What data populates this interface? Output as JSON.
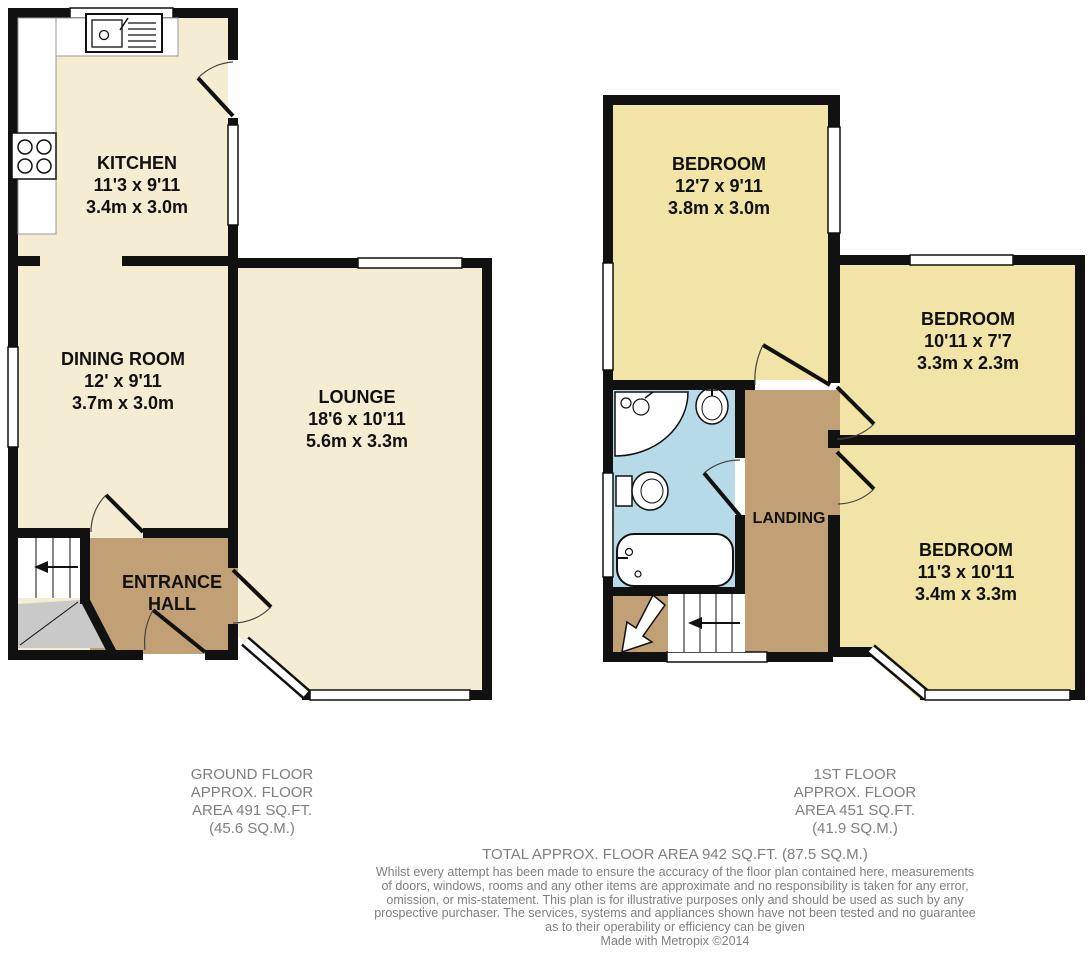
{
  "plan": {
    "colors": {
      "wall": "#111111",
      "ground_room_fill": "#F5EDD3",
      "bedroom_fill": "#F2E4A6",
      "hall_landing_fill": "#C2A075",
      "bathroom_fill": "#B7DAE8",
      "understairs_gray": "#C9C9C9",
      "caption_text": "#7F7F7F",
      "label_text": "#111111"
    },
    "ground_floor": {
      "rooms": [
        {
          "name": "KITCHEN",
          "imperial": "11'3 x 9'11",
          "metric": "3.4m x 3.0m"
        },
        {
          "name": "DINING ROOM",
          "imperial": "12' x 9'11",
          "metric": "3.7m x 3.0m"
        },
        {
          "name": "LOUNGE",
          "imperial": "18'6 x 10'11",
          "metric": "5.6m x 3.3m"
        },
        {
          "name": "ENTRANCE HALL"
        }
      ],
      "caption": {
        "lines": [
          "GROUND FLOOR",
          "APPROX. FLOOR",
          "AREA 491 SQ.FT.",
          "(45.6 SQ.M.)"
        ]
      },
      "fixtures": [
        "sink-icon",
        "hob-icon",
        "stairs-up-icon"
      ]
    },
    "first_floor": {
      "rooms": [
        {
          "name": "BEDROOM",
          "imperial": "12'7 x 9'11",
          "metric": "3.8m x 3.0m"
        },
        {
          "name": "BEDROOM",
          "imperial": "10'11 x 7'7",
          "metric": "3.3m x 2.3m"
        },
        {
          "name": "BEDROOM",
          "imperial": "11'3 x 10'11",
          "metric": "3.4m x 3.3m"
        },
        {
          "name": "LANDING"
        }
      ],
      "caption": {
        "lines": [
          "1ST FLOOR",
          "APPROX. FLOOR",
          "AREA 451 SQ.FT.",
          "(41.9 SQ.M.)"
        ]
      },
      "fixtures": [
        "corner-shower-icon",
        "basin-icon",
        "toilet-icon",
        "bath-icon",
        "stairs-down-icon"
      ]
    },
    "total_area": "TOTAL APPROX. FLOOR AREA 942 SQ.FT. (87.5 SQ.M.)",
    "disclaimer": {
      "lines": [
        "Whilst every attempt has been made to ensure the accuracy of the floor plan contained here, measurements",
        "of doors, windows, rooms and any other items are approximate and no responsibility is taken for any error,",
        "omission, or mis-statement. This plan is for illustrative purposes only and should be used as such by any",
        "prospective purchaser. The services, systems and appliances shown have not been tested and no guarantee",
        "as to their operability or efficiency can be given",
        "Made with Metropix ©2014"
      ]
    }
  }
}
